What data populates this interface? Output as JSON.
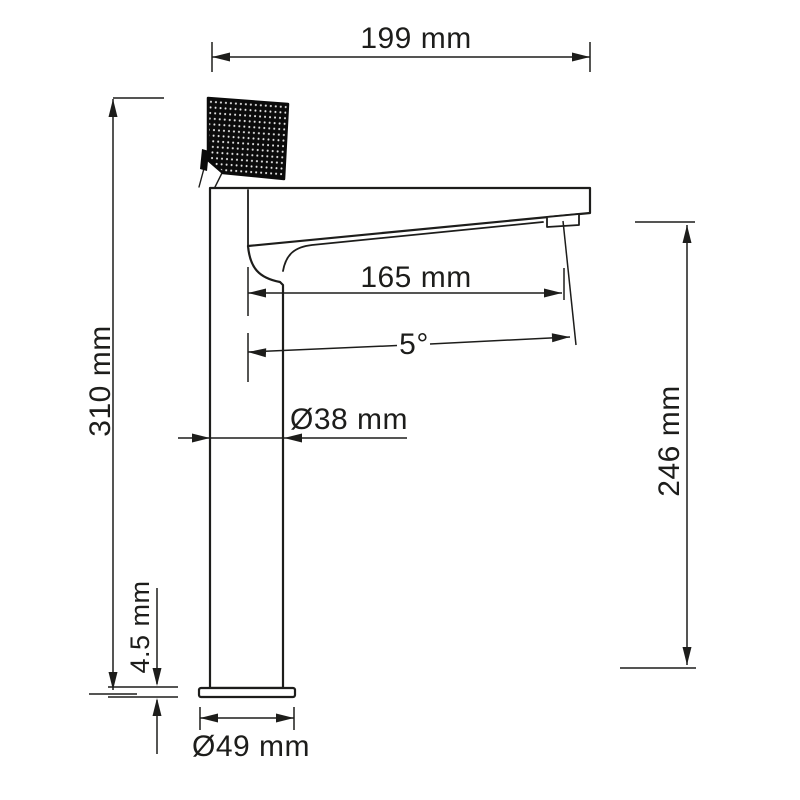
{
  "drawing": {
    "kind": "faucet-dimension-drawing",
    "view": "side elevation of single-lever tall basin mixer",
    "background_color": "#ffffff",
    "line_color": "#1d1d1b",
    "handle_color": "#0b0b0b",
    "dimensions": {
      "top_width": {
        "label": "199 mm",
        "meaning": "overall width across body top"
      },
      "total_height": {
        "label": "310 mm",
        "meaning": "overall height from base bottom to handle top"
      },
      "spout_reach": {
        "label": "165 mm",
        "meaning": "horizontal reach from body axis to aerator"
      },
      "spout_angle": {
        "label": "5°",
        "meaning": "downward tilt angle of spout"
      },
      "body_diameter": {
        "label": "Ø38 mm",
        "meaning": "diameter of vertical body column"
      },
      "base_thickness": {
        "label": "4.5 mm",
        "meaning": "thickness of base plate"
      },
      "outlet_height": {
        "label": "246 mm",
        "meaning": "height from reference plane to water outlet"
      },
      "base_diameter": {
        "label": "Ø49 mm",
        "meaning": "diameter of base plate"
      }
    }
  }
}
